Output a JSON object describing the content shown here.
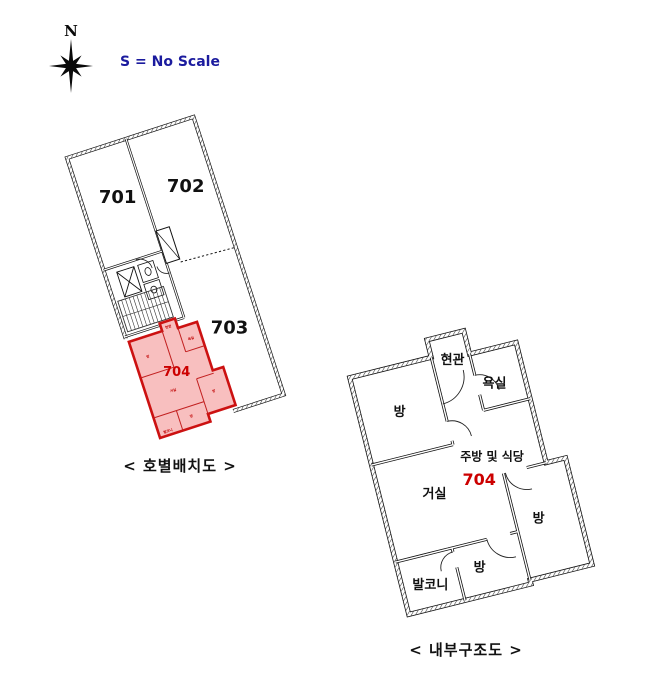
{
  "compass": {
    "north_label": "N"
  },
  "scale_note": "S = No Scale",
  "site_plan": {
    "caption": "< 호별배치도 >",
    "units": {
      "u701": "701",
      "u702": "702",
      "u703": "703",
      "u704": "704"
    },
    "unit_704_rooms": [
      "방",
      "현관",
      "욕실",
      "거실",
      "방",
      "방",
      "발코니"
    ]
  },
  "floor_plan": {
    "caption": "< 내부구조도 >",
    "unit_number": "704",
    "kitchen_label": "주방 및 식당",
    "rooms": {
      "entrance": "현관",
      "bath": "욕실",
      "room_top": "방",
      "living": "거실",
      "room_right": "방",
      "room_bottom": "방",
      "balcony": "발코니"
    }
  },
  "colors": {
    "highlight_fill": "#f8bfbf",
    "highlight_border": "#cc1111",
    "accent_red": "#cc0000",
    "note_blue": "#1b1b9e",
    "line_black": "#111111"
  }
}
